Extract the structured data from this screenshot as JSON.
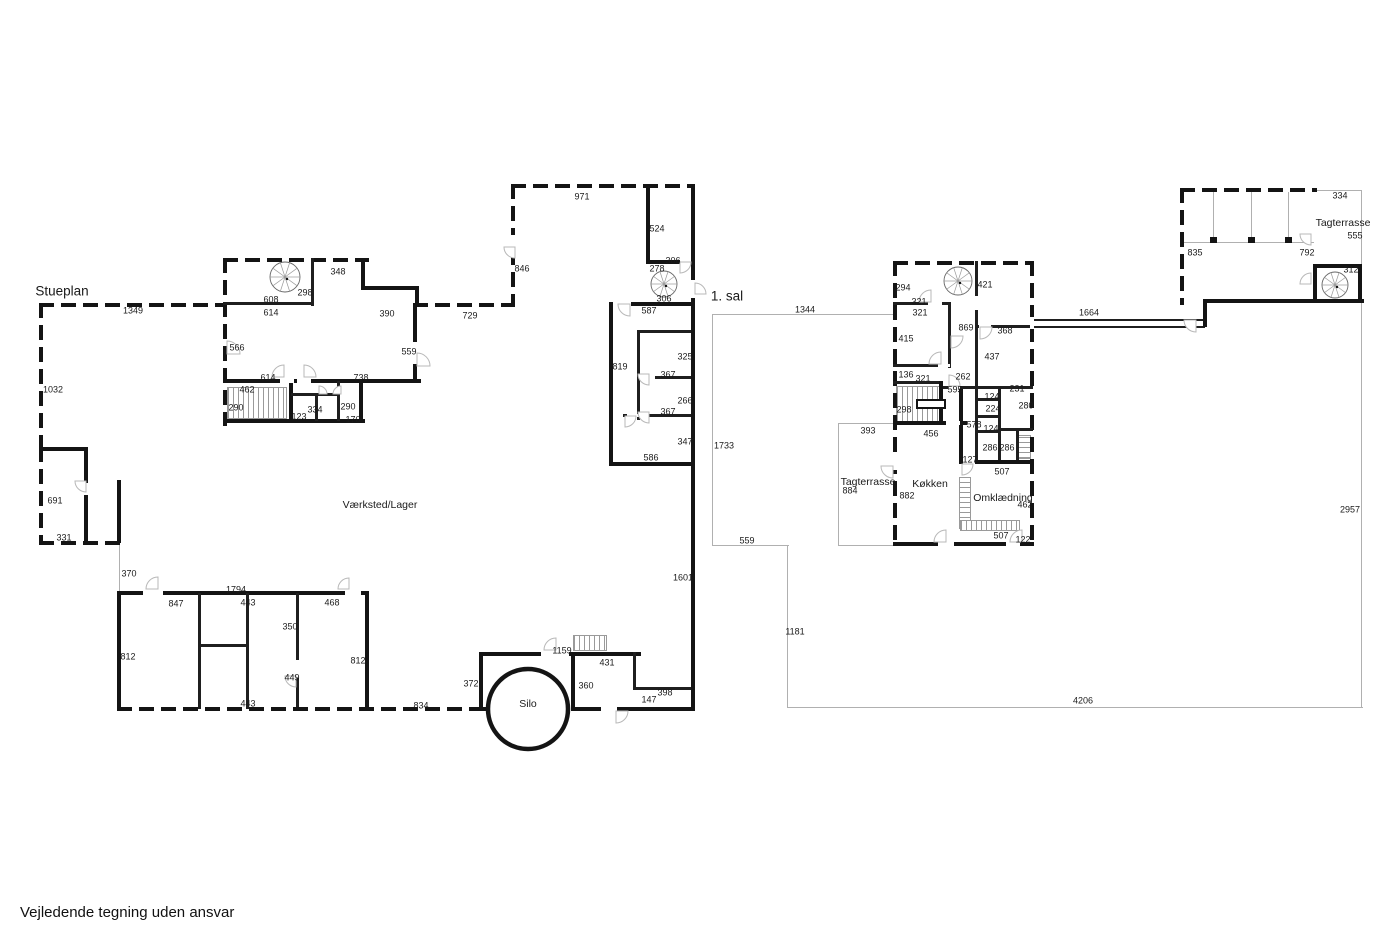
{
  "footer": {
    "disclaimer": "Vejledende tegning uden ansvar"
  },
  "colors": {
    "wall": "#141414",
    "thin_line": "#b0b0b0",
    "arc_stroke": "#b8b8b8",
    "text": "#1a1a1a",
    "background": "#ffffff"
  },
  "plan_titles": [
    {
      "text": "Stueplan",
      "x": 62,
      "y": 291
    },
    {
      "text": "1. sal",
      "x": 727,
      "y": 296
    }
  ],
  "room_labels": [
    {
      "text": "Værksted/Lager",
      "x": 380,
      "y": 505
    },
    {
      "text": "Silo",
      "x": 528,
      "y": 704
    },
    {
      "text": "Tagterrasse",
      "x": 868,
      "y": 482
    },
    {
      "text": "Køkken",
      "x": 930,
      "y": 484
    },
    {
      "text": "Omklædning",
      "x": 1003,
      "y": 498
    },
    {
      "text": "Tagterrasse",
      "x": 1343,
      "y": 223
    }
  ],
  "dim_labels": [
    {
      "text": "1349",
      "x": 133,
      "y": 311
    },
    {
      "text": "1032",
      "x": 53,
      "y": 390
    },
    {
      "text": "348",
      "x": 338,
      "y": 272
    },
    {
      "text": "298",
      "x": 305,
      "y": 293
    },
    {
      "text": "608",
      "x": 271,
      "y": 300
    },
    {
      "text": "614",
      "x": 271,
      "y": 313
    },
    {
      "text": "390",
      "x": 387,
      "y": 314
    },
    {
      "text": "729",
      "x": 470,
      "y": 316
    },
    {
      "text": "566",
      "x": 237,
      "y": 348
    },
    {
      "text": "559",
      "x": 409,
      "y": 352
    },
    {
      "text": "614",
      "x": 268,
      "y": 378
    },
    {
      "text": "738",
      "x": 361,
      "y": 378
    },
    {
      "text": "462",
      "x": 247,
      "y": 390
    },
    {
      "text": "290",
      "x": 236,
      "y": 408
    },
    {
      "text": "123",
      "x": 299,
      "y": 417
    },
    {
      "text": "334",
      "x": 315,
      "y": 410
    },
    {
      "text": "290",
      "x": 348,
      "y": 407
    },
    {
      "text": "170",
      "x": 353,
      "y": 420
    },
    {
      "text": "971",
      "x": 582,
      "y": 197
    },
    {
      "text": "846",
      "x": 522,
      "y": 269
    },
    {
      "text": "524",
      "x": 657,
      "y": 229
    },
    {
      "text": "306",
      "x": 673,
      "y": 261
    },
    {
      "text": "278",
      "x": 657,
      "y": 269
    },
    {
      "text": "306",
      "x": 664,
      "y": 299
    },
    {
      "text": "587",
      "x": 649,
      "y": 311
    },
    {
      "text": "819",
      "x": 620,
      "y": 367
    },
    {
      "text": "325",
      "x": 685,
      "y": 357
    },
    {
      "text": "367",
      "x": 668,
      "y": 375
    },
    {
      "text": "266",
      "x": 685,
      "y": 401
    },
    {
      "text": "367",
      "x": 668,
      "y": 412
    },
    {
      "text": "347",
      "x": 685,
      "y": 442
    },
    {
      "text": "586",
      "x": 651,
      "y": 458
    },
    {
      "text": "691",
      "x": 55,
      "y": 501
    },
    {
      "text": "331",
      "x": 64,
      "y": 538
    },
    {
      "text": "370",
      "x": 129,
      "y": 574
    },
    {
      "text": "1794",
      "x": 236,
      "y": 590
    },
    {
      "text": "847",
      "x": 176,
      "y": 604
    },
    {
      "text": "443",
      "x": 248,
      "y": 603
    },
    {
      "text": "468",
      "x": 332,
      "y": 603
    },
    {
      "text": "350",
      "x": 290,
      "y": 627
    },
    {
      "text": "812",
      "x": 128,
      "y": 657
    },
    {
      "text": "812",
      "x": 358,
      "y": 661
    },
    {
      "text": "449",
      "x": 292,
      "y": 678
    },
    {
      "text": "443",
      "x": 248,
      "y": 704
    },
    {
      "text": "834",
      "x": 421,
      "y": 706
    },
    {
      "text": "1159",
      "x": 562,
      "y": 651
    },
    {
      "text": "431",
      "x": 607,
      "y": 663
    },
    {
      "text": "372",
      "x": 471,
      "y": 684
    },
    {
      "text": "360",
      "x": 586,
      "y": 686
    },
    {
      "text": "398",
      "x": 665,
      "y": 693
    },
    {
      "text": "147",
      "x": 649,
      "y": 700
    },
    {
      "text": "1601",
      "x": 683,
      "y": 578
    },
    {
      "text": "1344",
      "x": 805,
      "y": 310
    },
    {
      "text": "294",
      "x": 903,
      "y": 288
    },
    {
      "text": "321",
      "x": 919,
      "y": 302
    },
    {
      "text": "321",
      "x": 920,
      "y": 313
    },
    {
      "text": "421",
      "x": 985,
      "y": 285
    },
    {
      "text": "869",
      "x": 966,
      "y": 328
    },
    {
      "text": "368",
      "x": 1005,
      "y": 331
    },
    {
      "text": "415",
      "x": 906,
      "y": 339
    },
    {
      "text": "437",
      "x": 992,
      "y": 357
    },
    {
      "text": "136",
      "x": 906,
      "y": 375
    },
    {
      "text": "321",
      "x": 923,
      "y": 379
    },
    {
      "text": "262",
      "x": 963,
      "y": 377
    },
    {
      "text": "595",
      "x": 955,
      "y": 390
    },
    {
      "text": "298",
      "x": 904,
      "y": 410
    },
    {
      "text": "231",
      "x": 1017,
      "y": 389
    },
    {
      "text": "124",
      "x": 992,
      "y": 397
    },
    {
      "text": "224",
      "x": 993,
      "y": 409
    },
    {
      "text": "280",
      "x": 1026,
      "y": 406
    },
    {
      "text": "578",
      "x": 974,
      "y": 425
    },
    {
      "text": "124",
      "x": 991,
      "y": 429
    },
    {
      "text": "286",
      "x": 990,
      "y": 448
    },
    {
      "text": "286",
      "x": 1007,
      "y": 448
    },
    {
      "text": "456",
      "x": 931,
      "y": 434
    },
    {
      "text": "127",
      "x": 970,
      "y": 460
    },
    {
      "text": "507",
      "x": 1002,
      "y": 472
    },
    {
      "text": "393",
      "x": 868,
      "y": 431
    },
    {
      "text": "884",
      "x": 850,
      "y": 491
    },
    {
      "text": "882",
      "x": 907,
      "y": 496
    },
    {
      "text": "462",
      "x": 1025,
      "y": 505
    },
    {
      "text": "507",
      "x": 1001,
      "y": 536
    },
    {
      "text": "122",
      "x": 1023,
      "y": 540
    },
    {
      "text": "1733",
      "x": 724,
      "y": 446
    },
    {
      "text": "559",
      "x": 747,
      "y": 541
    },
    {
      "text": "1181",
      "x": 795,
      "y": 632
    },
    {
      "text": "4206",
      "x": 1083,
      "y": 701
    },
    {
      "text": "2957",
      "x": 1350,
      "y": 510
    },
    {
      "text": "1664",
      "x": 1089,
      "y": 313
    },
    {
      "text": "334",
      "x": 1340,
      "y": 196
    },
    {
      "text": "555",
      "x": 1355,
      "y": 236
    },
    {
      "text": "835",
      "x": 1195,
      "y": 253
    },
    {
      "text": "792",
      "x": 1307,
      "y": 253
    },
    {
      "text": "312",
      "x": 1351,
      "y": 270
    }
  ],
  "walls": [
    [
      39,
      303,
      188,
      4,
      "d"
    ],
    [
      39,
      303,
      4,
      146,
      "d"
    ],
    [
      39,
      447,
      4,
      98,
      "d"
    ],
    [
      39,
      447,
      48,
      4,
      "b"
    ],
    [
      84,
      447,
      4,
      36,
      "b"
    ],
    [
      84,
      495,
      4,
      50,
      "b"
    ],
    [
      39,
      541,
      84,
      4,
      "d"
    ],
    [
      117,
      480,
      4,
      63,
      "b"
    ],
    [
      117,
      591,
      252,
      4,
      "b"
    ],
    [
      117,
      591,
      4,
      120,
      "b"
    ],
    [
      365,
      591,
      4,
      120,
      "b"
    ],
    [
      198,
      593,
      3,
      116,
      "i"
    ],
    [
      246,
      593,
      3,
      116,
      "i"
    ],
    [
      296,
      593,
      3,
      116,
      "i"
    ],
    [
      198,
      644,
      51,
      3,
      "i"
    ],
    [
      117,
      707,
      368,
      4,
      "d"
    ],
    [
      479,
      652,
      4,
      59,
      "b"
    ],
    [
      479,
      652,
      162,
      4,
      "b"
    ],
    [
      571,
      652,
      4,
      59,
      "b"
    ],
    [
      633,
      652,
      3,
      38,
      "i"
    ],
    [
      633,
      687,
      61,
      3,
      "i"
    ],
    [
      571,
      707,
      124,
      4,
      "b"
    ],
    [
      483,
      707,
      90,
      4,
      "d"
    ],
    [
      223,
      258,
      146,
      4,
      "d"
    ],
    [
      223,
      258,
      4,
      168,
      "d"
    ],
    [
      223,
      302,
      88,
      3,
      "i"
    ],
    [
      311,
      258,
      3,
      48,
      "i"
    ],
    [
      361,
      258,
      4,
      32,
      "b"
    ],
    [
      361,
      286,
      58,
      4,
      "b"
    ],
    [
      415,
      286,
      4,
      20,
      "b"
    ],
    [
      413,
      303,
      102,
      4,
      "d"
    ],
    [
      413,
      303,
      4,
      80,
      "b"
    ],
    [
      223,
      379,
      198,
      4,
      "b"
    ],
    [
      289,
      381,
      4,
      42,
      "b"
    ],
    [
      223,
      419,
      142,
      4,
      "b"
    ],
    [
      359,
      381,
      4,
      42,
      "b"
    ],
    [
      315,
      393,
      3,
      28,
      "i"
    ],
    [
      337,
      381,
      3,
      40,
      "i"
    ],
    [
      291,
      393,
      46,
      3,
      "i"
    ],
    [
      511,
      184,
      4,
      123,
      "d"
    ],
    [
      511,
      184,
      184,
      4,
      "d"
    ],
    [
      646,
      184,
      4,
      80,
      "b"
    ],
    [
      646,
      260,
      34,
      4,
      "b"
    ],
    [
      691,
      184,
      4,
      124,
      "b"
    ],
    [
      609,
      302,
      84,
      4,
      "b"
    ],
    [
      609,
      302,
      4,
      164,
      "b"
    ],
    [
      637,
      330,
      56,
      3,
      "i"
    ],
    [
      637,
      330,
      3,
      90,
      "i"
    ],
    [
      637,
      376,
      56,
      3,
      "i"
    ],
    [
      623,
      414,
      70,
      3,
      "i"
    ],
    [
      609,
      462,
      84,
      4,
      "b"
    ],
    [
      691,
      306,
      4,
      405,
      "b"
    ],
    [
      893,
      261,
      141,
      4,
      "d"
    ],
    [
      893,
      261,
      4,
      285,
      "d"
    ],
    [
      1030,
      261,
      4,
      285,
      "d"
    ],
    [
      893,
      542,
      141,
      4,
      "b"
    ],
    [
      893,
      302,
      58,
      3,
      "i"
    ],
    [
      948,
      302,
      3,
      66,
      "i"
    ],
    [
      893,
      364,
      58,
      3,
      "i"
    ],
    [
      893,
      381,
      50,
      3,
      "i"
    ],
    [
      939,
      381,
      4,
      44,
      "b"
    ],
    [
      893,
      421,
      74,
      4,
      "b"
    ],
    [
      959,
      386,
      4,
      78,
      "b"
    ],
    [
      943,
      386,
      90,
      3,
      "i"
    ],
    [
      975,
      261,
      3,
      201,
      "i"
    ],
    [
      975,
      325,
      58,
      3,
      "i"
    ],
    [
      975,
      398,
      25,
      3,
      "i"
    ],
    [
      975,
      415,
      25,
      3,
      "i"
    ],
    [
      975,
      430,
      25,
      3,
      "i"
    ],
    [
      998,
      388,
      3,
      74,
      "i"
    ],
    [
      998,
      428,
      35,
      3,
      "i"
    ],
    [
      1016,
      430,
      3,
      32,
      "i"
    ],
    [
      959,
      460,
      74,
      4,
      "b"
    ],
    [
      1033,
      319,
      172,
      2,
      "i"
    ],
    [
      1033,
      326,
      172,
      2,
      "i"
    ],
    [
      1180,
      188,
      137,
      4,
      "d"
    ],
    [
      1180,
      188,
      4,
      117,
      "d"
    ],
    [
      1203,
      299,
      161,
      4,
      "b"
    ],
    [
      1203,
      299,
      4,
      28,
      "b"
    ],
    [
      1313,
      264,
      4,
      37,
      "b"
    ],
    [
      1313,
      264,
      49,
      4,
      "b"
    ],
    [
      1358,
      264,
      4,
      39,
      "b"
    ],
    [
      1210,
      237,
      7,
      6,
      "b"
    ],
    [
      1248,
      237,
      7,
      6,
      "b"
    ],
    [
      1285,
      237,
      7,
      6,
      "b"
    ],
    [
      916,
      399,
      30,
      10,
      "o"
    ],
    [
      143,
      591,
      20,
      4,
      "g"
    ],
    [
      345,
      591,
      16,
      4,
      "g"
    ],
    [
      296,
      660,
      3,
      18,
      "g"
    ],
    [
      541,
      652,
      28,
      4,
      "g"
    ],
    [
      601,
      707,
      16,
      4,
      "g"
    ],
    [
      413,
      342,
      4,
      22,
      "g"
    ],
    [
      280,
      379,
      14,
      4,
      "g"
    ],
    [
      297,
      379,
      14,
      4,
      "g"
    ],
    [
      511,
      235,
      4,
      20,
      "g"
    ],
    [
      691,
      280,
      4,
      18,
      "g"
    ],
    [
      613,
      302,
      18,
      4,
      "g"
    ],
    [
      641,
      376,
      14,
      3,
      "g"
    ],
    [
      627,
      414,
      14,
      3,
      "g"
    ],
    [
      938,
      542,
      16,
      4,
      "g"
    ],
    [
      1006,
      542,
      14,
      4,
      "g"
    ],
    [
      928,
      302,
      14,
      3,
      "g"
    ],
    [
      938,
      364,
      12,
      3,
      "g"
    ],
    [
      946,
      421,
      14,
      4,
      "g"
    ],
    [
      948,
      386,
      12,
      3,
      "g"
    ],
    [
      979,
      325,
      12,
      3,
      "g"
    ],
    [
      975,
      296,
      3,
      14,
      "g"
    ],
    [
      963,
      460,
      12,
      4,
      "g"
    ],
    [
      893,
      452,
      4,
      18,
      "g"
    ],
    [
      1030,
      317,
      4,
      12,
      "g"
    ]
  ],
  "thin_lines": [
    [
      712,
      314,
      184,
      1
    ],
    [
      712,
      314,
      1,
      232
    ],
    [
      712,
      545,
      77,
      1
    ],
    [
      787,
      545,
      1,
      163
    ],
    [
      787,
      707,
      576,
      1
    ],
    [
      1361,
      299,
      1,
      409
    ],
    [
      838,
      423,
      58,
      1
    ],
    [
      838,
      423,
      1,
      123
    ],
    [
      838,
      545,
      58,
      1
    ],
    [
      1315,
      190,
      47,
      1
    ],
    [
      1361,
      190,
      1,
      110
    ],
    [
      1184,
      242,
      130,
      1
    ],
    [
      1213,
      192,
      1,
      51
    ],
    [
      1251,
      192,
      1,
      51
    ],
    [
      1288,
      192,
      1,
      51
    ],
    [
      119,
      543,
      1,
      50
    ]
  ],
  "stairs": [
    [
      227,
      387,
      60,
      32,
      "v"
    ],
    [
      573,
      635,
      34,
      16,
      "v"
    ],
    [
      896,
      386,
      45,
      36,
      "v"
    ],
    [
      959,
      477,
      12,
      52,
      "h"
    ],
    [
      960,
      520,
      60,
      11,
      "v"
    ],
    [
      1018,
      435,
      13,
      24,
      "h"
    ]
  ],
  "spiral_stairs": [
    [
      285,
      277,
      15
    ],
    [
      664,
      284,
      13
    ],
    [
      958,
      281,
      14
    ],
    [
      1335,
      285,
      13
    ]
  ],
  "silo": {
    "cx": 528,
    "cy": 709,
    "r": 40
  },
  "door_arcs": [
    [
      227,
      354,
      13,
      270
    ],
    [
      417,
      366,
      13,
      270
    ],
    [
      284,
      377,
      12,
      180
    ],
    [
      304,
      377,
      12,
      270
    ],
    [
      86,
      481,
      11,
      90
    ],
    [
      158,
      589,
      12,
      180
    ],
    [
      556,
      650,
      12,
      180
    ],
    [
      616,
      711,
      12,
      0
    ],
    [
      680,
      262,
      11,
      0
    ],
    [
      695,
      294,
      11,
      270
    ],
    [
      630,
      304,
      12,
      90
    ],
    [
      649,
      374,
      11,
      90
    ],
    [
      649,
      412,
      11,
      90
    ],
    [
      625,
      416,
      11,
      0
    ],
    [
      515,
      247,
      11,
      90
    ],
    [
      296,
      676,
      11,
      90
    ],
    [
      349,
      589,
      11,
      180
    ],
    [
      319,
      394,
      8,
      270
    ],
    [
      341,
      394,
      8,
      180
    ],
    [
      931,
      302,
      12,
      180
    ],
    [
      941,
      364,
      12,
      180
    ],
    [
      949,
      386,
      11,
      270
    ],
    [
      893,
      466,
      12,
      90
    ],
    [
      946,
      542,
      12,
      180
    ],
    [
      1022,
      542,
      12,
      180
    ],
    [
      962,
      464,
      11,
      0
    ],
    [
      951,
      336,
      12,
      0
    ],
    [
      980,
      327,
      12,
      0
    ],
    [
      1196,
      320,
      12,
      90
    ],
    [
      1311,
      284,
      11,
      180
    ],
    [
      1311,
      234,
      11,
      90
    ]
  ]
}
